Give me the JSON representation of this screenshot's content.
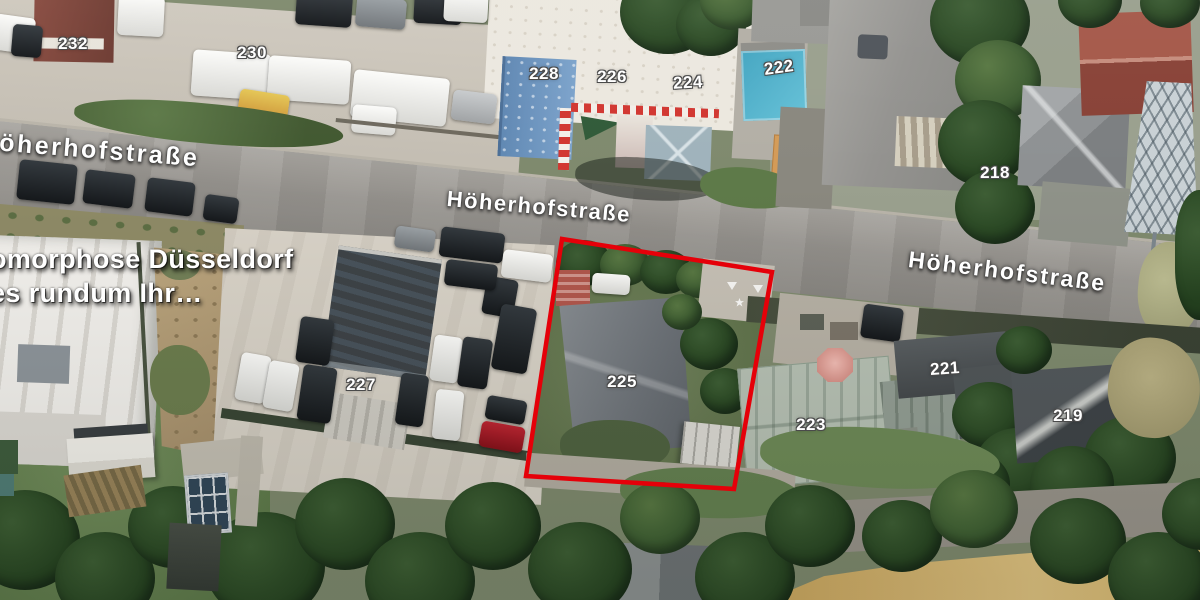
{
  "colors": {
    "outline_red": "#e50009",
    "label_white": "#ffffff"
  },
  "map": {
    "type": "satellite-imagery",
    "street_labels": [
      {
        "id": "left",
        "text": "Höherhofstraße"
      },
      {
        "id": "center",
        "text": "Höherhofstraße"
      },
      {
        "id": "right",
        "text": "Höherhofstraße"
      }
    ],
    "house_number_labels": [
      {
        "text": "232"
      },
      {
        "text": "230"
      },
      {
        "text": "228"
      },
      {
        "text": "226"
      },
      {
        "text": "224"
      },
      {
        "text": "222"
      },
      {
        "text": "218"
      },
      {
        "text": "227"
      },
      {
        "text": "225"
      },
      {
        "text": "223"
      },
      {
        "text": "221"
      },
      {
        "text": "219"
      }
    ],
    "business_overlay": {
      "line1": "omorphose Düsseldorf",
      "line2": "es rundum Ihr…"
    },
    "property_outline": {
      "label": "225",
      "color": "#e50009",
      "points": "562,239 772,272 734,489 526,476"
    }
  }
}
